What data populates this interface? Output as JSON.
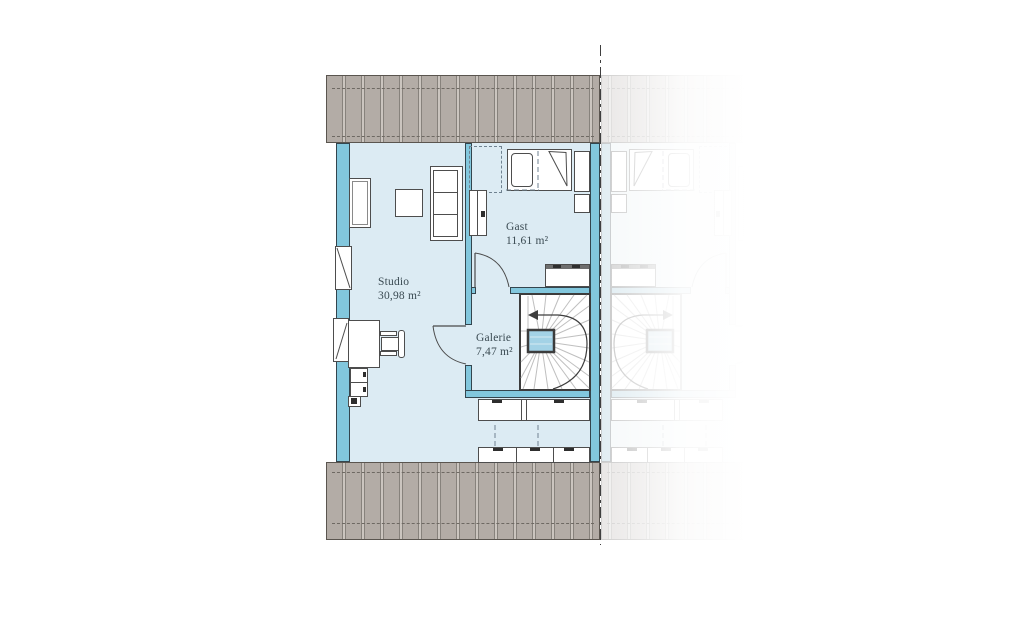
{
  "rooms": {
    "studio": {
      "name": "Studio",
      "area": "30,98 m²"
    },
    "gast": {
      "name": "Gast",
      "area": "11,61 m²"
    },
    "galerie": {
      "name": "Galerie",
      "area": "7,47 m²"
    }
  },
  "colors": {
    "wall": "#82c7dd",
    "floor": "#dcebf3",
    "stair_void": "#a3d2e6",
    "roof_overhang": "#b3aca6",
    "label_text": "#3a4a52"
  },
  "icons": {
    "stair_direction_arrow": "left-pointing-arrow"
  }
}
